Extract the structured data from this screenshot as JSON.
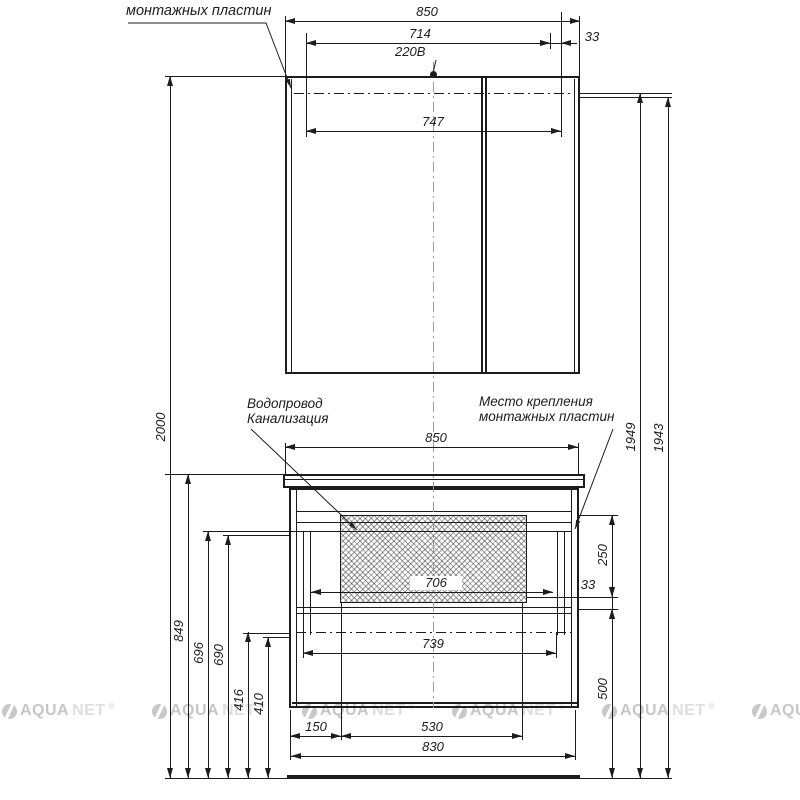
{
  "drawing": {
    "top_label": "монтажных пластин",
    "outlet_label": "220В",
    "callouts": {
      "plumbing_line1": "Водопровод",
      "plumbing_line2": "Канализация",
      "mounting_line1": "Место крепления",
      "mounting_line2": "монтажных пластин"
    },
    "dimensions": {
      "mirror_width": "850",
      "mirror_714": "714",
      "mirror_33": "33",
      "mirror_747": "747",
      "vanity_width": "850",
      "cutout_706": "706",
      "drawer_739": "739",
      "offset_150": "150",
      "cutout_530": "530",
      "vanity_830": "830",
      "height_2000": "2000",
      "height_849": "849",
      "height_696": "696",
      "height_690": "690",
      "height_416": "416",
      "height_410": "410",
      "height_1949": "1949",
      "height_1943": "1943",
      "cutout_250": "250",
      "rail_33": "33",
      "bottom_500": "500"
    },
    "watermark": {
      "brand": "AQUANET",
      "registered": "®"
    }
  }
}
